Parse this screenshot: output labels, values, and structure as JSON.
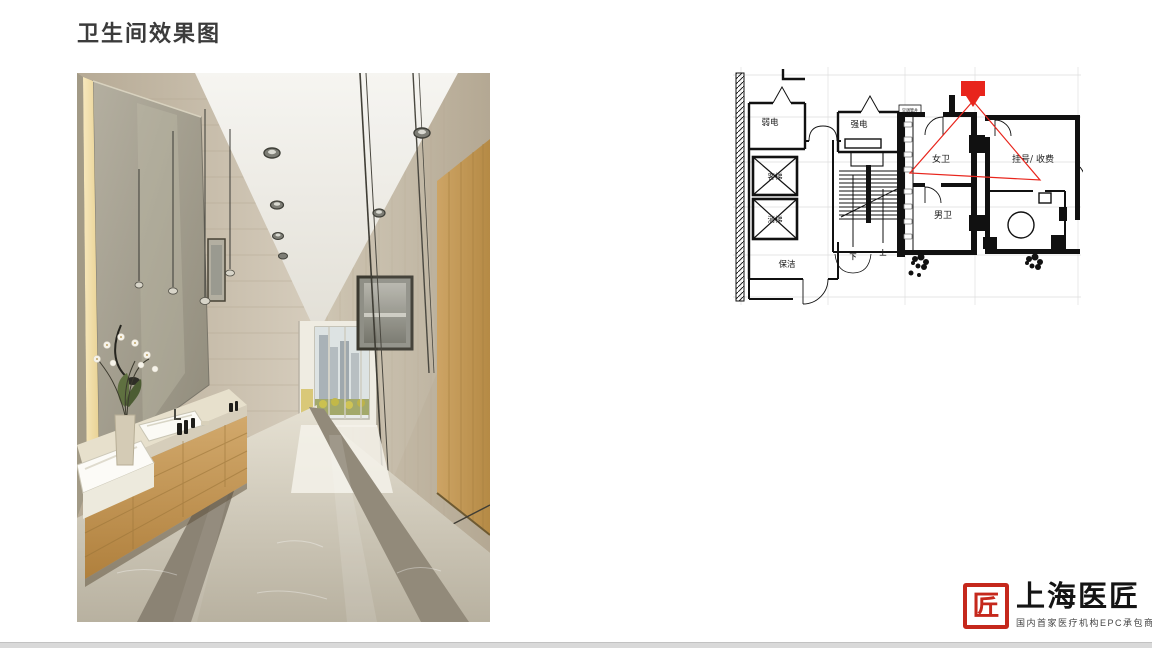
{
  "slide": {
    "title": "卫生间效果图",
    "background": "#ffffff",
    "footer_bar_color": "#d9d9d9"
  },
  "floor_plan": {
    "accent_red": "#e8251c",
    "line_color": "#151515",
    "labels": {
      "weak_power": "弱电",
      "strong_power": "强电",
      "passenger_elevator": "客梯",
      "fire_elevator": "消梯",
      "cleaning": "保洁",
      "female_toilet": "女卫",
      "male_toilet": "男卫",
      "registration_cashier": "挂号/ 收费",
      "ac_shaft": "空调管井",
      "stair_down": "下",
      "stair_up": "上"
    }
  },
  "logo": {
    "name": "上海医匠",
    "tagline": "国内首家医疗机构EPC承包商",
    "seal_glyph": "匠",
    "seal_color": "#c5281c"
  }
}
